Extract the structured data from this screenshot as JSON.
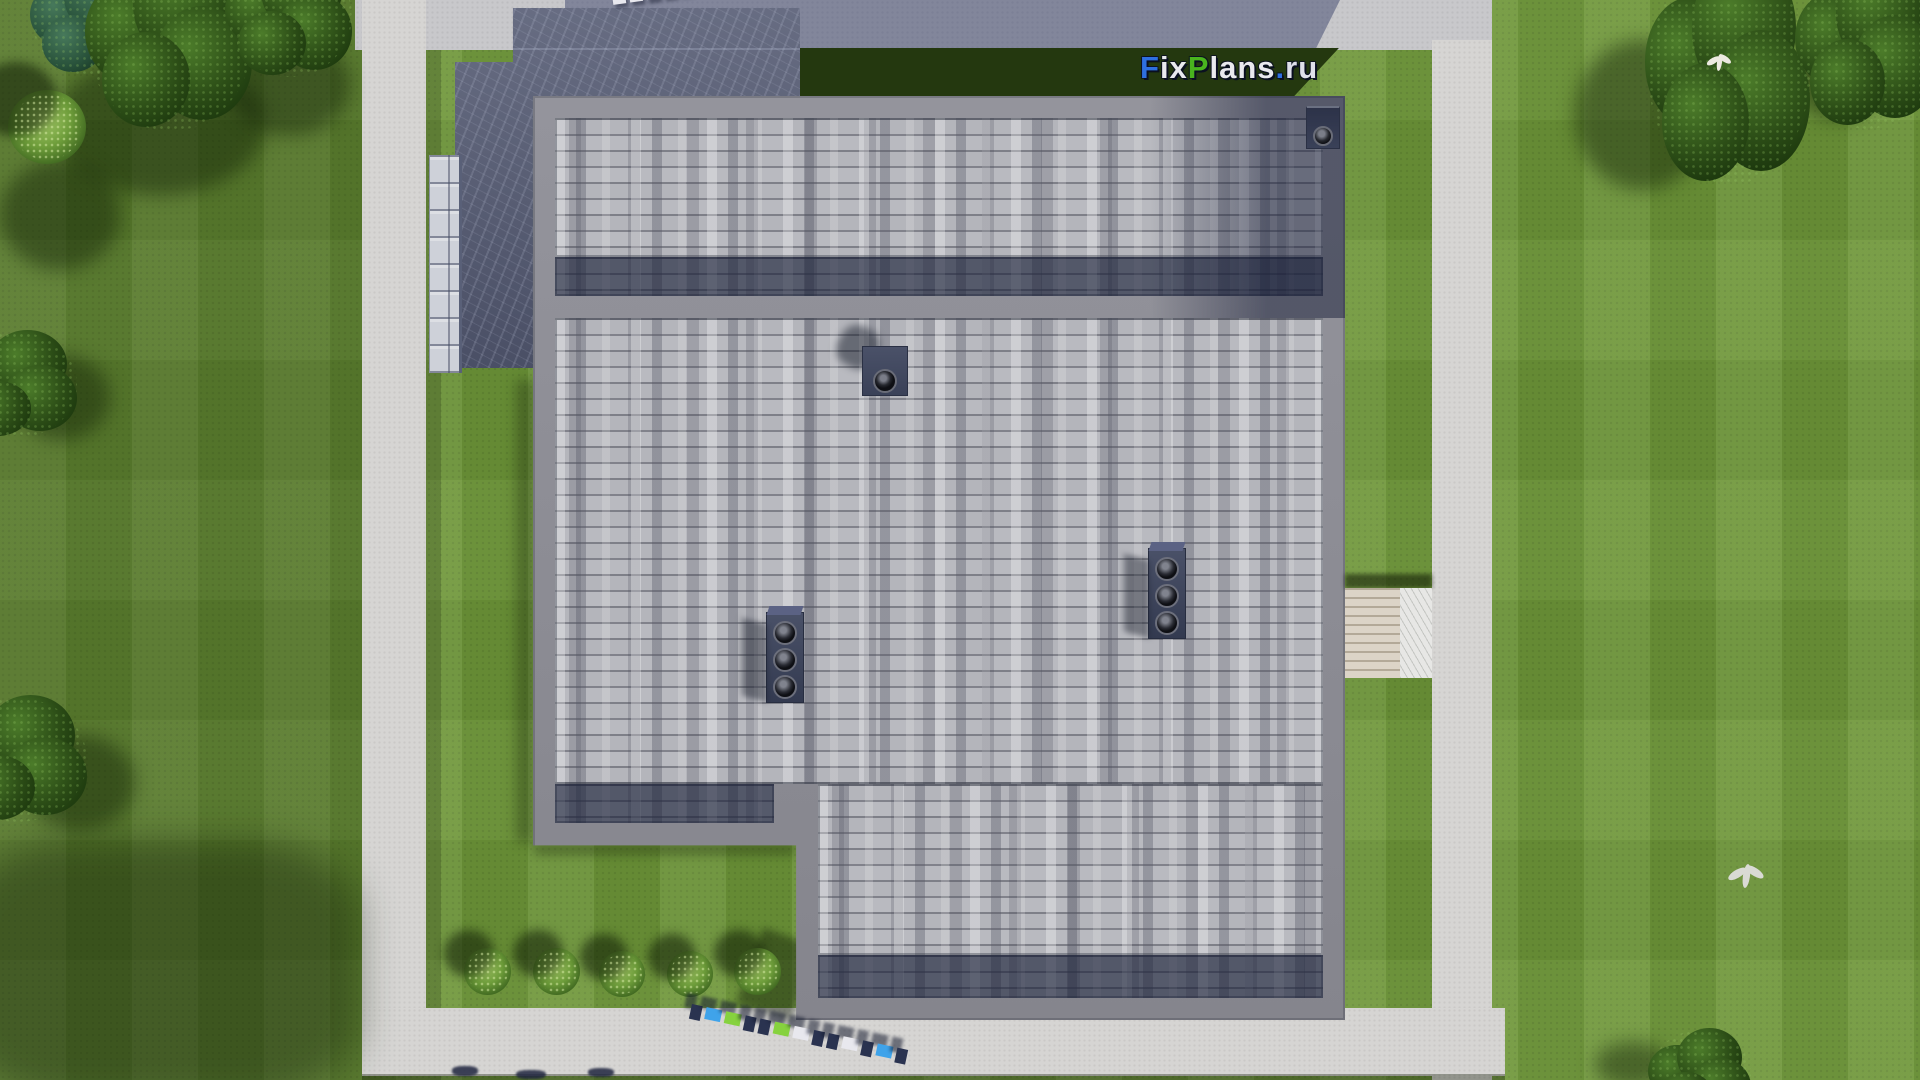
{
  "logo": {
    "text": "FixPlans.ru",
    "parts": [
      {
        "text": "F",
        "color": "#2e6fe0"
      },
      {
        "text": "ix",
        "color": "#e9e9ee"
      },
      {
        "text": "P",
        "color": "#49b41e"
      },
      {
        "text": "lans",
        "color": "#e9e9ee"
      },
      {
        "text": ".",
        "color": "#2e6fe0"
      },
      {
        "text": "ru",
        "color": "#dfe0ea"
      }
    ]
  },
  "watermarks": {
    "top": {
      "text": "FixPlans.ru",
      "style": "small 3d tiles, cropped by top edge"
    },
    "bottom": {
      "text": "FixPlans.ru",
      "style": "3d extruded tiles lying on bottom path"
    }
  },
  "scene": {
    "view": "top-down aerial render of a flat-roofed house plot",
    "house": {
      "roof": "gray composite shingles with parapet borders",
      "sections": 2,
      "terrace_roof": "dark slate flat roof, top-left, with side stairs"
    },
    "rooftop_units": {
      "triple_vent_groups": 2,
      "single_chimneys": 2
    },
    "landscape": {
      "perimeter_paths": 4,
      "entrance_walkway": 1,
      "bushes": 5,
      "tree_clusters": 8,
      "birds": 2
    }
  },
  "palette": {
    "grass_base": "#6e9639",
    "grass_shade": "#24380f",
    "path": "#d6d5d3",
    "pavement_shadow": "#8b90a6",
    "roof_parapet": "#8d8e96",
    "shingle_base": "#b4b5bb",
    "shingle_dark": "#434a60",
    "flatroof": "#565c74",
    "tree": "#2b4c16",
    "watermark_navy": "#2a3350",
    "watermark_blue": "#3fa3ea",
    "watermark_green": "#86d23e"
  }
}
